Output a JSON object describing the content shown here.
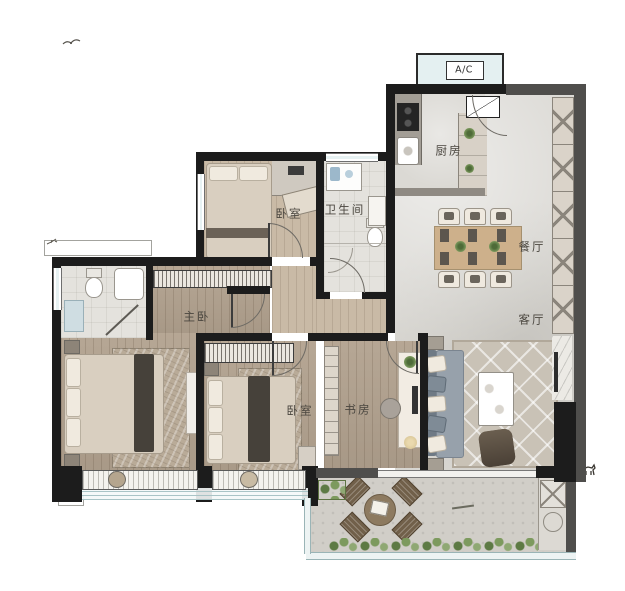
{
  "plan": {
    "title": "apartment floor plan",
    "labels": {
      "ac": "A/C",
      "kitchen": "厨房",
      "bedroom_top": "卧室",
      "bathroom": "卫生间",
      "dining": "餐厅",
      "living": "客厅",
      "master_bedroom": "主卧",
      "bedroom_second": "卧室",
      "study": "书房"
    },
    "colors": {
      "wall_dark": "#1c1c1c",
      "wall_gray": "#4f4e4c",
      "wood_mid": "#b2a28f",
      "wood_light": "#c9baa6",
      "tile_light": "#d8d6d1",
      "bath_tile": "#e4e2dd",
      "balcony_tile": "#d1cec8",
      "glass": "#e7f2f3",
      "greenery": "#5d7a44",
      "label_text": "#4a463f"
    }
  }
}
